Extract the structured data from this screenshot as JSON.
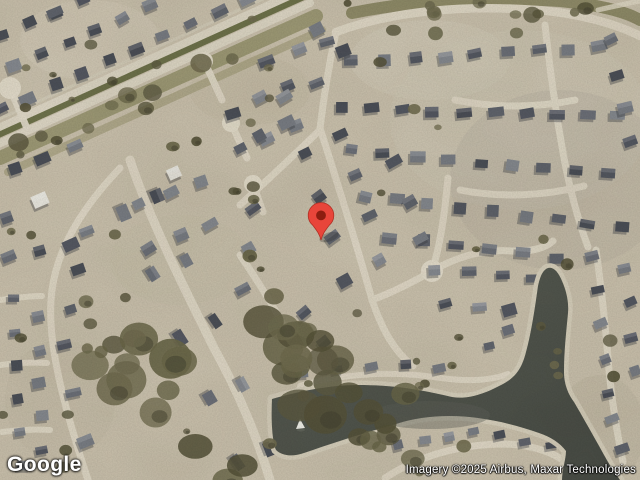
{
  "map": {
    "provider_logo": "Google",
    "attribution": "Imagery ©2025 Airbus, Maxar Technologies",
    "view": "satellite",
    "marker": {
      "tip_x": 321,
      "tip_y": 240,
      "color": "#E8453A",
      "dot_color": "#8C1D10",
      "outline_color": "#B03024"
    },
    "palette": {
      "ground": "#cdc4b0",
      "road": "#e3dccb",
      "water_light": "#5a5e55",
      "water_dark": "#484c45",
      "shore_path": "#d9d2bf",
      "grass": "#6f734b",
      "verge": "#8b8a5f",
      "tree_colors": [
        "#5e5b42",
        "#6a6749",
        "#565339",
        "#716d50"
      ],
      "roof_colors": [
        "#555963",
        "#61656e",
        "#6d717a",
        "#7a7e86",
        "#878b92",
        "#4c5059"
      ],
      "roof_shadow": "#3a3d42",
      "white_roof": "#eceae3"
    }
  }
}
